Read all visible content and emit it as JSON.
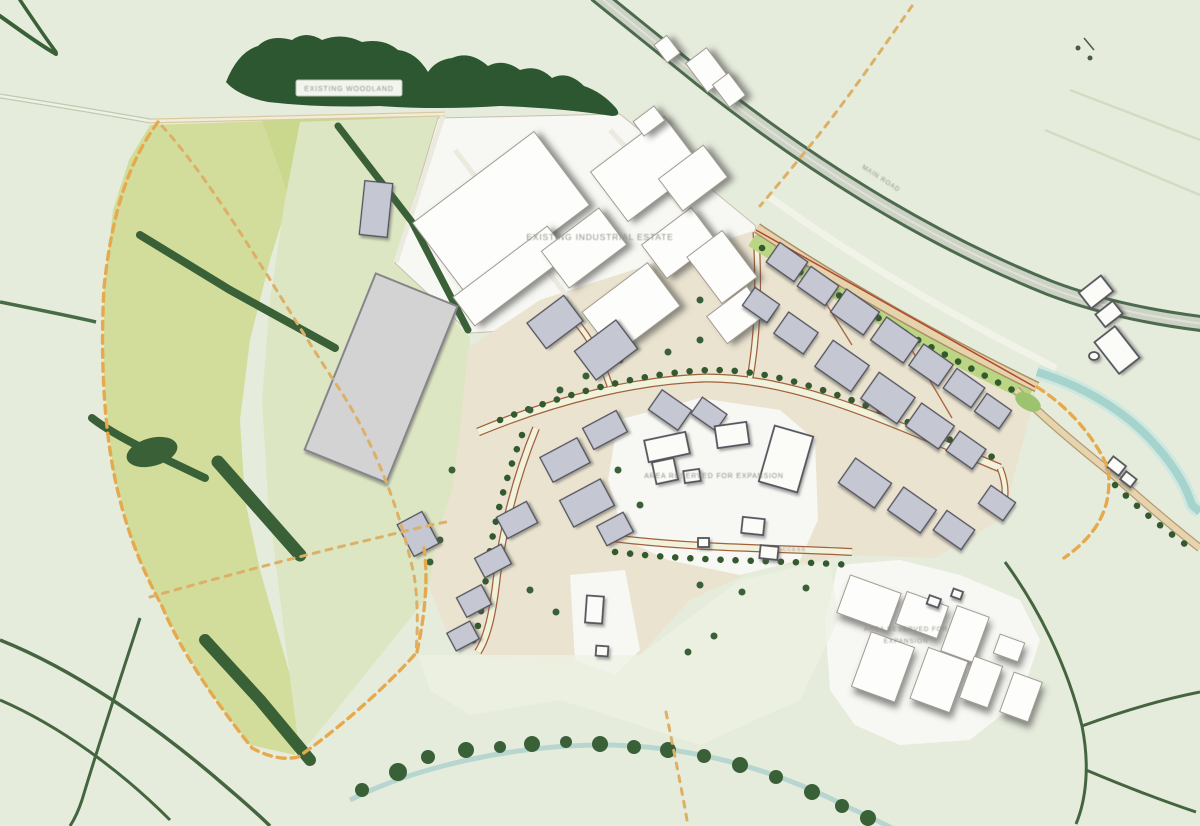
{
  "map": {
    "type": "site-development-masterplan",
    "labels": {
      "woodland": "EXISTING WOODLAND",
      "mainRoad": "MAIN ROAD",
      "estate": "EXISTING INDUSTRIAL ESTATE",
      "central": "AREA RESERVED FOR EXPANSION",
      "access": "ACCESS",
      "se1": "AREA RESERVED FOR",
      "se2": "EXPANSION"
    },
    "colors": {
      "bg": "#e6ecdc",
      "field": "#d3dd9b",
      "fieldLight": "#c9d88c",
      "grass": "#dde6c3",
      "woodland": "#2c5730",
      "hedge": "#3a6038",
      "whiteArea": "#f7f7f3",
      "beige": "#eae3cf",
      "bldgGray": "#c5c7d2",
      "bldgGrayStroke": "#50505a",
      "bldgWhite": "#fdfdfb",
      "bldgWhiteStroke": "#a09a90",
      "roadTan": "#e3cfa6",
      "roadPale": "#f1f2db",
      "roadEdge": "#a2603e",
      "mainRoadGray": "#ccd2c5",
      "mainRoadEdge": "#3f6040",
      "river": "#a6d4cd",
      "stream": "#b7d6d0",
      "orangeDash": "#e6a94e",
      "verge": "#bad584",
      "treeDot": "#33592e",
      "labelGray": "#8f8f88"
    },
    "features": [
      "woodland",
      "fields",
      "site-boundary",
      "existing-industrial-estate",
      "development-plots",
      "main-road",
      "secondary-road",
      "river",
      "stream",
      "hedgerows",
      "footpaths",
      "reserved-areas"
    ]
  }
}
